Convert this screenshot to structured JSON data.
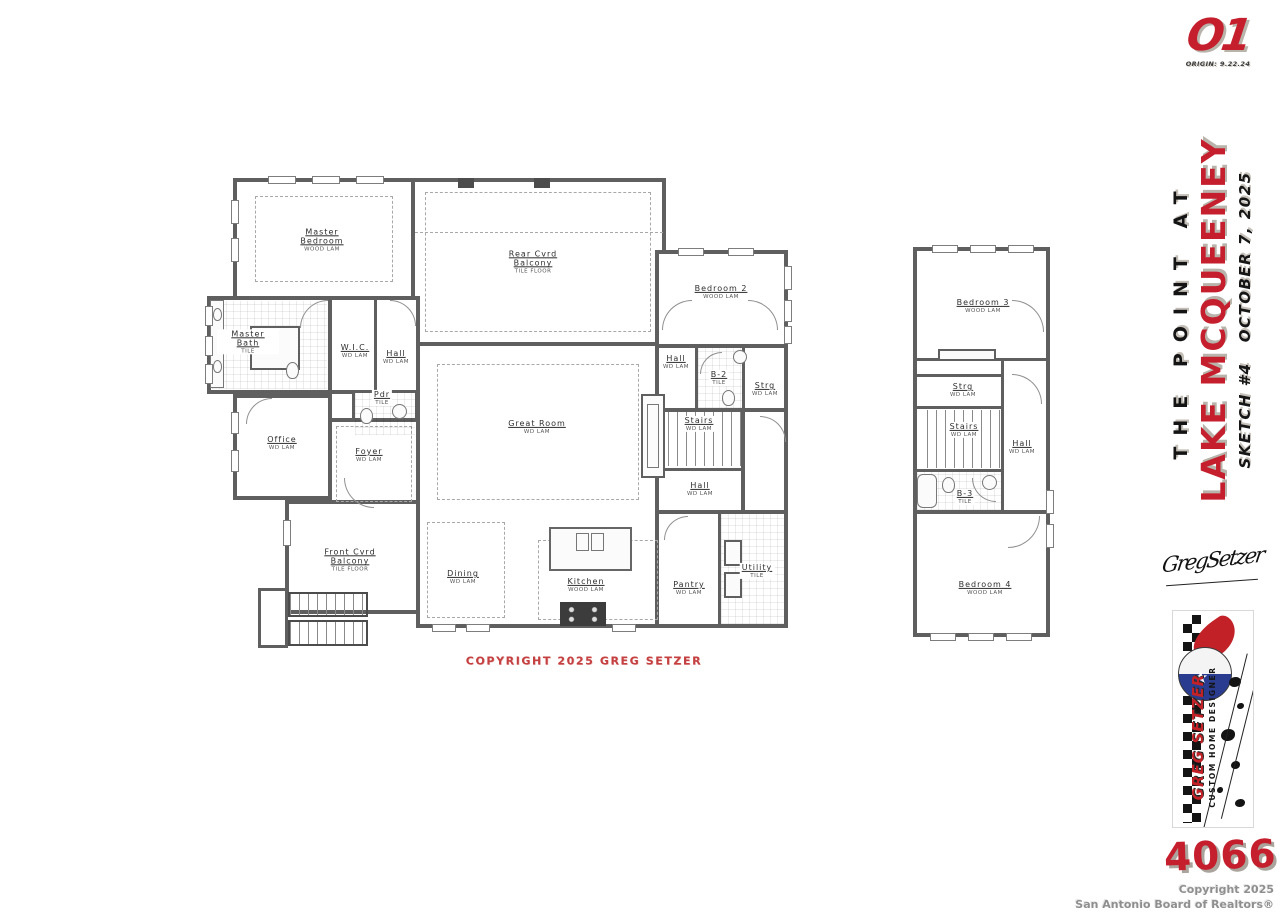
{
  "header": {
    "logo": "O1",
    "origin": "ORIGIN: 9.22.24"
  },
  "title_block": {
    "project_line": "THE POINT AT",
    "location_line": "LAKE MCQUEENEY",
    "sketch_line": "SKETCH #4   OCTOBER 7, 2025"
  },
  "signature": {
    "name": "GregSetzer"
  },
  "badge": {
    "designer": "GREG SETZER",
    "tagline": "CUSTOM HOME DESIGNER"
  },
  "plan_number": "4066",
  "plan_copyright": "COPYRIGHT 2025 GREG SETZER",
  "footer": {
    "line1": "Copyright 2025",
    "line2": "San Antonio Board of Realtors®"
  },
  "colors": {
    "accent_red": "#c51f2e",
    "wall_gray": "#5f5f5f",
    "shadow_gray": "#b9b4ab"
  },
  "floor1": {
    "rooms": [
      {
        "name": "Master Bedroom",
        "floor": "WOOD LAM"
      },
      {
        "name": "Rear Cvrd Balcony",
        "floor": "TILE FLOOR"
      },
      {
        "name": "Master Bath",
        "floor": "TILE"
      },
      {
        "name": "W.I.C.",
        "floor": "WD LAM"
      },
      {
        "name": "Hall",
        "floor": "WD LAM"
      },
      {
        "name": "Pdr",
        "floor": "TILE"
      },
      {
        "name": "Office",
        "floor": "WD LAM"
      },
      {
        "name": "Foyer",
        "floor": "WD LAM"
      },
      {
        "name": "Front Cvrd Balcony",
        "floor": "TILE FLOOR"
      },
      {
        "name": "Great Room",
        "floor": "WD LAM"
      },
      {
        "name": "Dining",
        "floor": "WD LAM"
      },
      {
        "name": "Kitchen",
        "floor": "WOOD LAM"
      },
      {
        "name": "Bedroom 2",
        "floor": "WOOD LAM"
      },
      {
        "name": "Hall",
        "floor": "WD LAM"
      },
      {
        "name": "B-2",
        "floor": "TILE"
      },
      {
        "name": "Strg",
        "floor": "WD LAM"
      },
      {
        "name": "Stairs",
        "floor": "WD LAM"
      },
      {
        "name": "Hall",
        "floor": "WD LAM"
      },
      {
        "name": "Pantry",
        "floor": "WD LAM"
      },
      {
        "name": "Utility",
        "floor": "TILE"
      }
    ]
  },
  "floor2": {
    "rooms": [
      {
        "name": "Bedroom 3",
        "floor": "WOOD LAM"
      },
      {
        "name": "Strg",
        "floor": "WD LAM"
      },
      {
        "name": "Stairs",
        "floor": "WD LAM"
      },
      {
        "name": "Hall",
        "floor": "WD LAM"
      },
      {
        "name": "B-3",
        "floor": "TILE"
      },
      {
        "name": "Bedroom 4",
        "floor": "WOOD LAM"
      }
    ]
  }
}
